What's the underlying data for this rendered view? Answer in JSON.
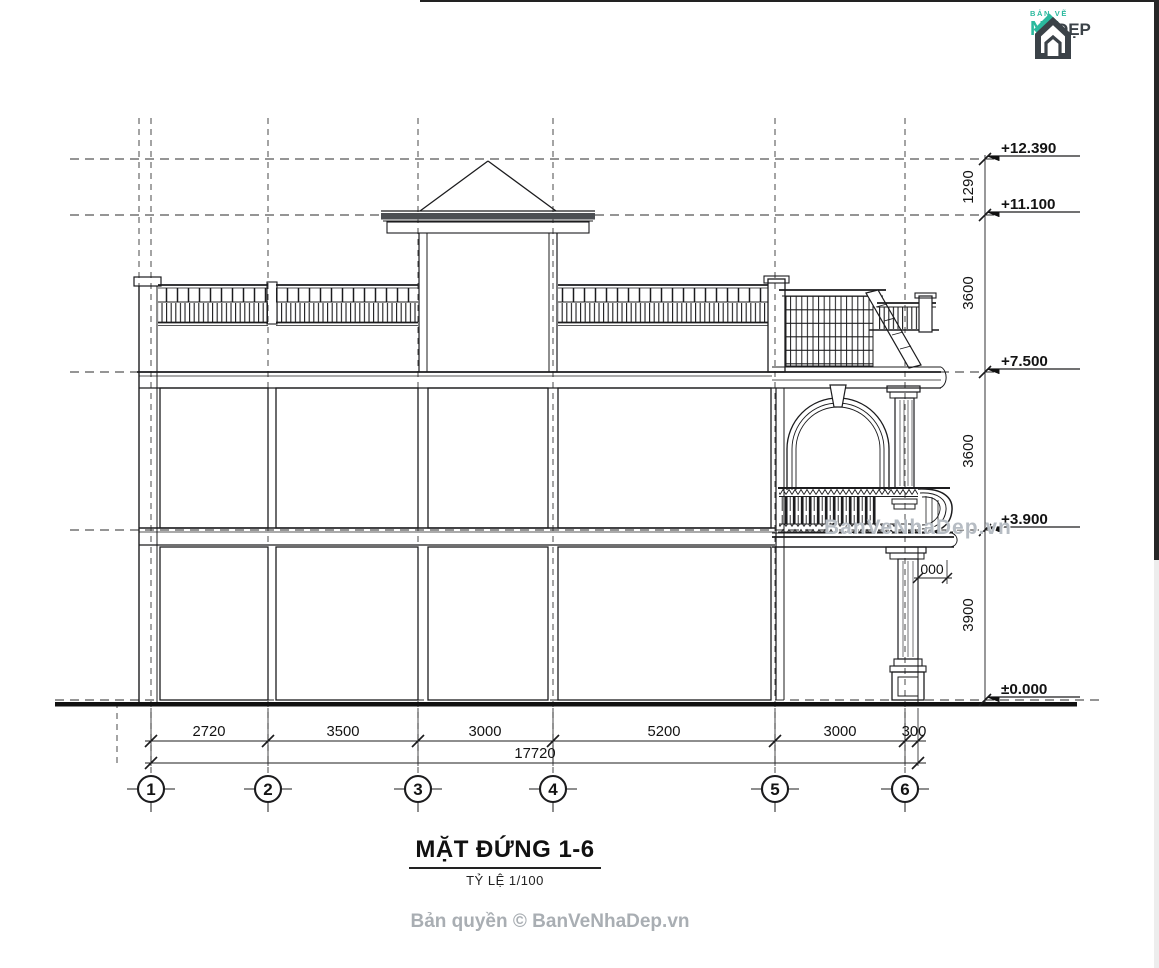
{
  "logo": {
    "line1": "BẢN VẼ",
    "line2": "NH",
    "suffix": "ĐẸP"
  },
  "drawing": {
    "levels": [
      {
        "label": "+12.390"
      },
      {
        "label": "+11.100"
      },
      {
        "label": "+7.500"
      },
      {
        "label": "+3.900"
      },
      {
        "label": "±0.000"
      }
    ],
    "vdims": [
      "1290",
      "3600",
      "3600",
      "3900"
    ],
    "hdims": [
      "2720",
      "3500",
      "3000",
      "5200",
      "3000",
      "300"
    ],
    "total": "17720",
    "grids": [
      "1",
      "2",
      "3",
      "4",
      "5",
      "6"
    ],
    "detail_dim": "000"
  },
  "titleblock": {
    "title": "MẶT ĐỨNG 1-6",
    "scale": "TỶ LỆ 1/100"
  },
  "watermark": "BanVeNhaDep.vn",
  "copyright": "Bản quyền © BanVeNhaDep.vn",
  "colors": {
    "ink": "#1c1c1e",
    "brand_green": "#2bb99e",
    "brand_dark": "#3b4248",
    "watermark_gray": "#b6bcc3",
    "copyright_gray": "#a9aeb3"
  }
}
